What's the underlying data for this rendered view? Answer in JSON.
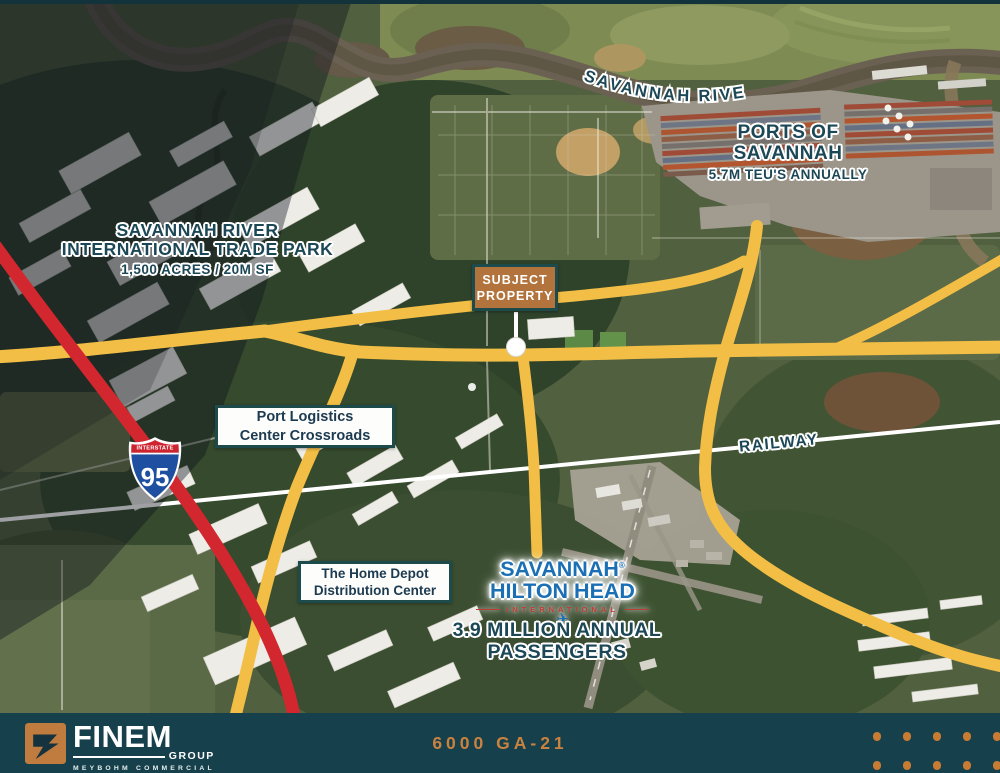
{
  "colors": {
    "road_yellow": "#F2BE45",
    "road_red": "#D2272E",
    "label_navy": "#1C4756",
    "box_border": "#1D4B4B",
    "box_text": "#1C3A50",
    "subject_fill": "#B2743C",
    "footer_bg": "#16404B",
    "accent_orange": "#C9823F",
    "airport_blue": "#1A6FB5",
    "airport_red": "#C23B33"
  },
  "map": {
    "river_label": "SAVANNAH RIVER",
    "ports": {
      "line1": "PORTS OF",
      "line2": "SAVANNAH",
      "subtitle": "5.7M TEU'S ANNUALLY"
    },
    "trade_park": {
      "line1": "SAVANNAH RIVER",
      "line2": "INTERNATIONAL TRADE PARK",
      "subtitle": "1,500 ACRES / 20M SF"
    },
    "railway_label": "RAILWAY",
    "interstate": {
      "label": "INTERSTATE",
      "number": "95"
    },
    "callouts": {
      "subject": {
        "line1": "SUBJECT",
        "line2": "PROPERTY"
      },
      "port_logistics": {
        "line1": "Port Logistics",
        "line2": "Center Crossroads"
      },
      "home_depot": {
        "line1": "The Home Depot",
        "line2": "Distribution Center"
      }
    },
    "airport": {
      "logo_line1": "SAVANNAH",
      "registered": "®",
      "logo_line2": "HILTON HEAD",
      "logo_line3": "INTERNATIONAL",
      "stat_line1": "3.9 MILLION ANNUAL",
      "stat_line2": "PASSENGERS"
    }
  },
  "footer": {
    "brand": "FINEM",
    "brand_sub": "GROUP",
    "brand_tagline": "MEYBOHM COMMERCIAL",
    "address": "6000 GA-21"
  }
}
